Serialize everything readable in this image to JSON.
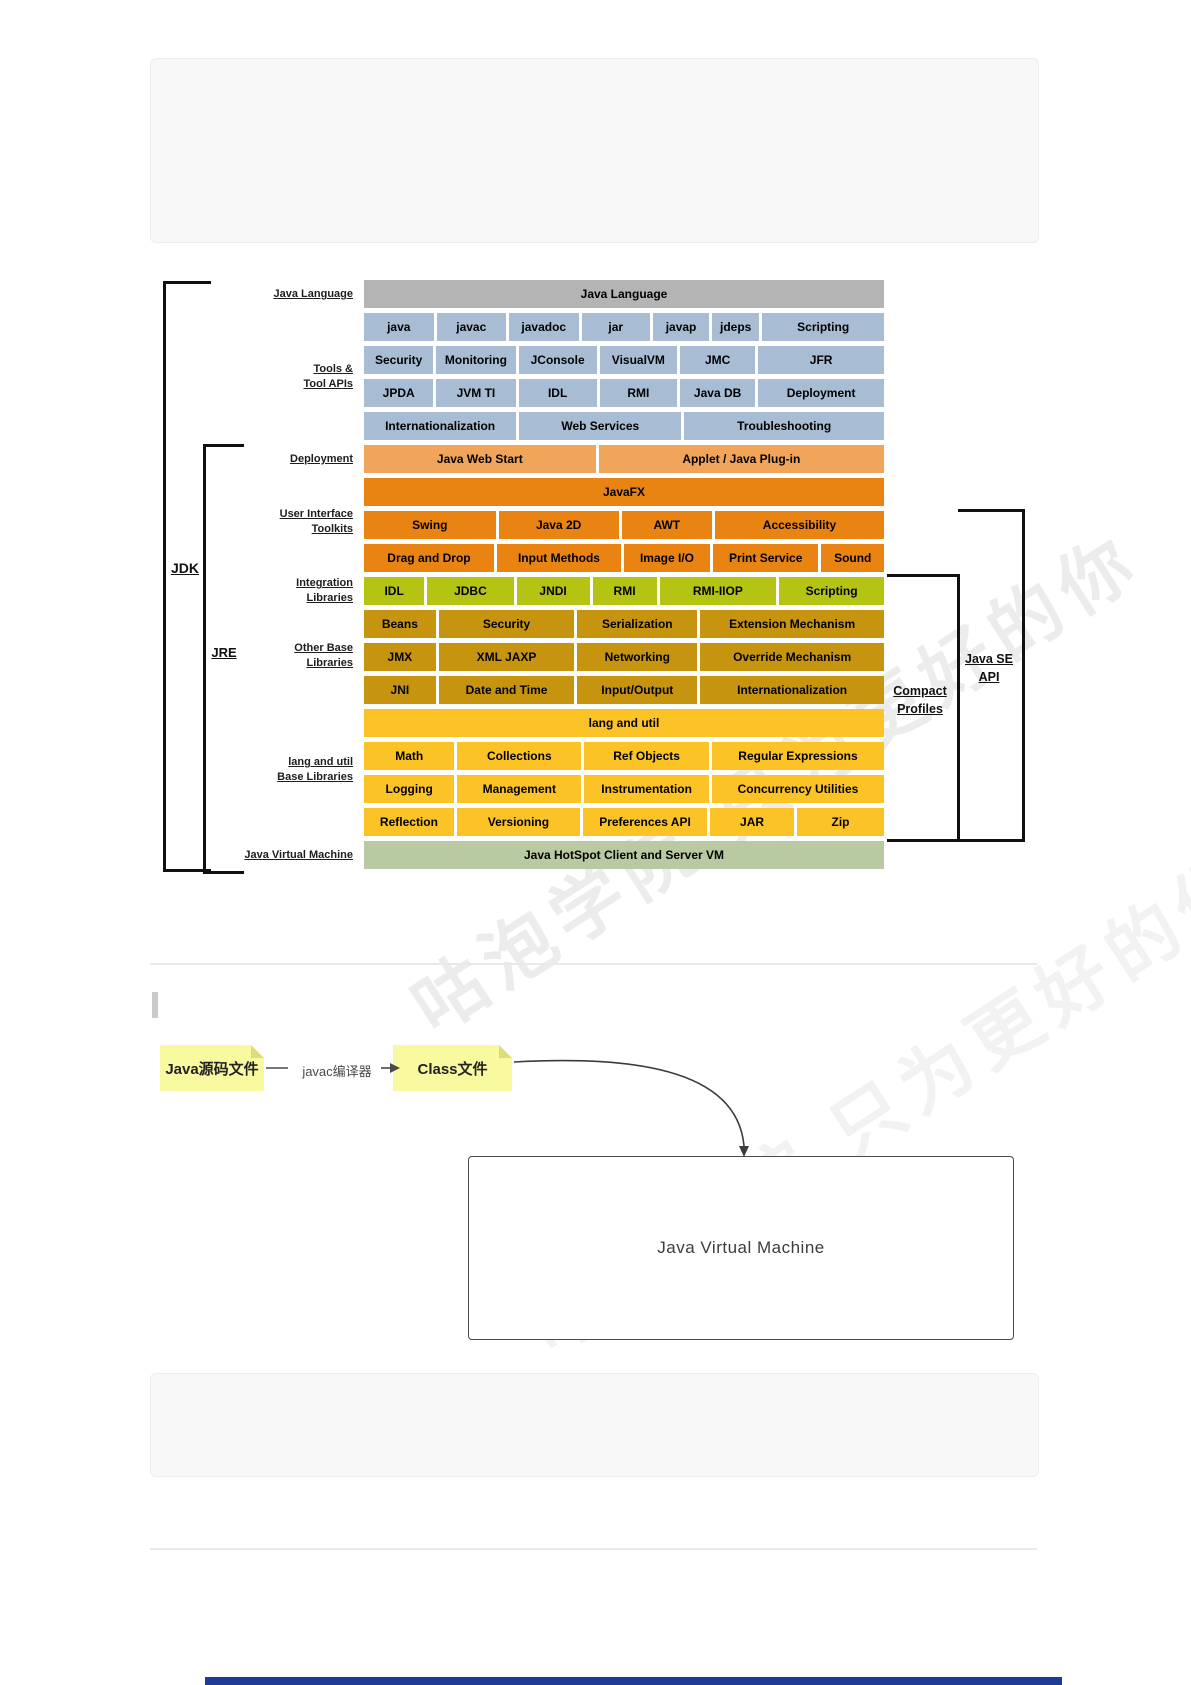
{
  "watermark": {
    "text": "咕泡学院 只为更好的你"
  },
  "diagram": {
    "side_labels": [
      {
        "lines": [
          "Java Language"
        ]
      },
      {
        "lines": [
          "Tools &",
          "Tool APIs"
        ]
      },
      {
        "lines": [
          "Deployment"
        ]
      },
      {
        "lines": [
          "User Interface",
          "Toolkits"
        ]
      },
      {
        "lines": [
          "Integration",
          "Libraries"
        ]
      },
      {
        "lines": [
          "Other Base",
          "Libraries"
        ]
      },
      {
        "lines": [
          "lang and util",
          "Base Libraries"
        ]
      },
      {
        "lines": [
          "Java Virtual Machine"
        ]
      }
    ],
    "brackets": {
      "jdk": "JDK",
      "jre": "JRE",
      "compact_profiles": [
        "Compact",
        "Profiles"
      ],
      "java_se_api": [
        "Java SE",
        "API"
      ]
    },
    "rows": [
      {
        "color": "gray",
        "cells": [
          {
            "label": "Java Language",
            "w": 520
          }
        ]
      },
      {
        "color": "blue",
        "cells": [
          {
            "label": "java",
            "w": 72
          },
          {
            "label": "javac",
            "w": 72
          },
          {
            "label": "javadoc",
            "w": 72
          },
          {
            "label": "jar",
            "w": 71
          },
          {
            "label": "javap",
            "w": 58
          },
          {
            "label": "jdeps",
            "w": 49
          },
          {
            "label": "Scripting",
            "w": 126
          }
        ]
      },
      {
        "color": "blue",
        "cells": [
          {
            "label": "Security",
            "w": 70
          },
          {
            "label": "Monitoring",
            "w": 80
          },
          {
            "label": "JConsole",
            "w": 79
          },
          {
            "label": "VisualVM",
            "w": 78
          },
          {
            "label": "JMC",
            "w": 76
          },
          {
            "label": "JFR",
            "w": 127
          }
        ]
      },
      {
        "color": "blue",
        "cells": [
          {
            "label": "JPDA",
            "w": 70
          },
          {
            "label": "JVM TI",
            "w": 80
          },
          {
            "label": "IDL",
            "w": 79
          },
          {
            "label": "RMI",
            "w": 78
          },
          {
            "label": "Java DB",
            "w": 76
          },
          {
            "label": "Deployment",
            "w": 127
          }
        ]
      },
      {
        "color": "blue",
        "cells": [
          {
            "label": "Internationalization",
            "w": 154
          },
          {
            "label": "Web Services",
            "w": 164
          },
          {
            "label": "Troubleshooting",
            "w": 202
          }
        ]
      },
      {
        "color": "lorange",
        "cells": [
          {
            "label": "Java Web Start",
            "w": 233
          },
          {
            "label": "Applet / Java Plug-in",
            "w": 287
          }
        ]
      },
      {
        "color": "orange",
        "cells": [
          {
            "label": "JavaFX",
            "w": 520
          }
        ]
      },
      {
        "color": "orange",
        "cells": [
          {
            "label": "Swing",
            "w": 134
          },
          {
            "label": "Java 2D",
            "w": 122
          },
          {
            "label": "AWT",
            "w": 92
          },
          {
            "label": "Accessibility",
            "w": 172
          }
        ]
      },
      {
        "color": "orange",
        "cells": [
          {
            "label": "Drag and Drop",
            "w": 133
          },
          {
            "label": "Input Methods",
            "w": 127
          },
          {
            "label": "Image I/O",
            "w": 88
          },
          {
            "label": "Print Service",
            "w": 108
          },
          {
            "label": "Sound",
            "w": 64
          }
        ]
      },
      {
        "color": "ygreen",
        "cells": [
          {
            "label": "IDL",
            "w": 62
          },
          {
            "label": "JDBC",
            "w": 89
          },
          {
            "label": "JNDI",
            "w": 75
          },
          {
            "label": "RMI",
            "w": 66
          },
          {
            "label": "RMI-IIOP",
            "w": 120
          },
          {
            "label": "Scripting",
            "w": 108
          }
        ]
      },
      {
        "color": "gold",
        "cells": [
          {
            "label": "Beans",
            "w": 73
          },
          {
            "label": "Security",
            "w": 138
          },
          {
            "label": "Serialization",
            "w": 122
          },
          {
            "label": "Extension Mechanism",
            "w": 187
          }
        ]
      },
      {
        "color": "gold",
        "cells": [
          {
            "label": "JMX",
            "w": 73
          },
          {
            "label": "XML JAXP",
            "w": 138
          },
          {
            "label": "Networking",
            "w": 122
          },
          {
            "label": "Override Mechanism",
            "w": 187
          }
        ]
      },
      {
        "color": "gold",
        "cells": [
          {
            "label": "JNI",
            "w": 73
          },
          {
            "label": "Date and Time",
            "w": 138
          },
          {
            "label": "Input/Output",
            "w": 122
          },
          {
            "label": "Internationalization",
            "w": 187
          }
        ]
      },
      {
        "color": "amber",
        "cells": [
          {
            "label": "lang and util",
            "w": 520
          }
        ]
      },
      {
        "color": "amber",
        "cells": [
          {
            "label": "Math",
            "w": 92
          },
          {
            "label": "Collections",
            "w": 126
          },
          {
            "label": "Ref Objects",
            "w": 127
          },
          {
            "label": "Regular Expressions",
            "w": 175
          }
        ]
      },
      {
        "color": "amber",
        "cells": [
          {
            "label": "Logging",
            "w": 92
          },
          {
            "label": "Management",
            "w": 126
          },
          {
            "label": "Instrumentation",
            "w": 127
          },
          {
            "label": "Concurrency Utilities",
            "w": 175
          }
        ]
      },
      {
        "color": "amber",
        "cells": [
          {
            "label": "Reflection",
            "w": 92
          },
          {
            "label": "Versioning",
            "w": 126
          },
          {
            "label": "Preferences API",
            "w": 127
          },
          {
            "label": "JAR",
            "w": 86
          },
          {
            "label": "Zip",
            "w": 89
          }
        ]
      },
      {
        "color": "green",
        "cells": [
          {
            "label": "Java HotSpot Client and Server VM",
            "w": 520
          }
        ]
      }
    ]
  },
  "flow": {
    "source_note": "Java源码文件",
    "compiler_label": "javac编译器",
    "class_note": "Class文件",
    "jvm_box_label": "Java Virtual Machine"
  }
}
